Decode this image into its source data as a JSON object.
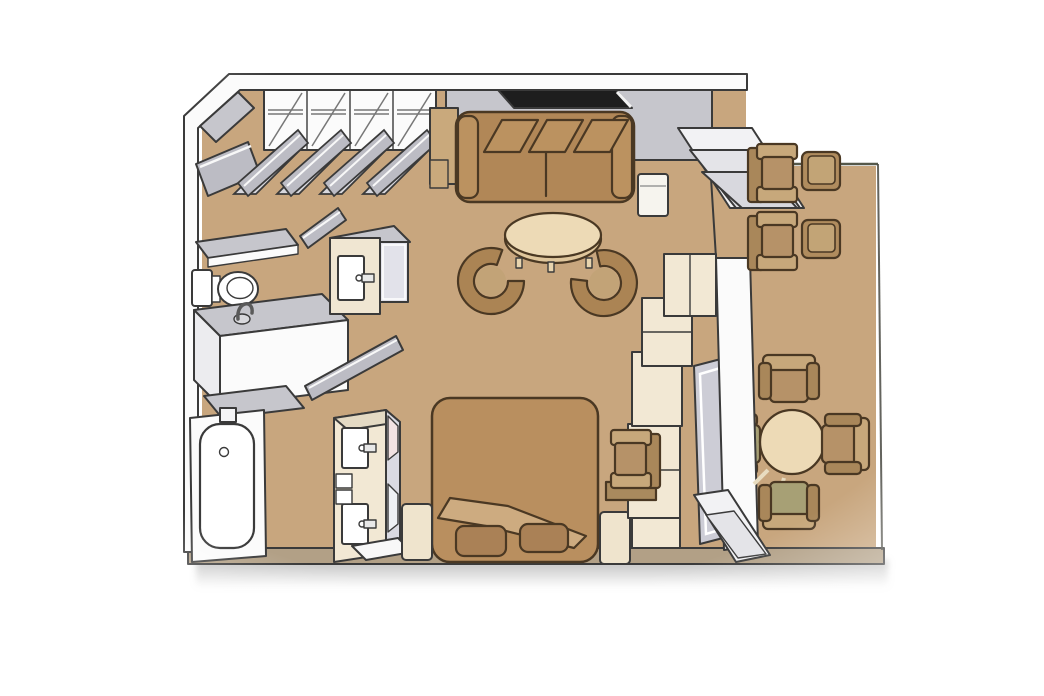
{
  "plan": {
    "kind": "floor-plan",
    "view": "isometric-top-down",
    "areas": [
      "entry",
      "closet-wall",
      "bathroom",
      "living-area",
      "bedroom-area",
      "balcony"
    ],
    "furniture": [
      "entry-door",
      "wardrobe-closet-bays",
      "closet-bifold-doors",
      "minibar-cabinet",
      "sofa",
      "wall-window",
      "sofa-side-table",
      "coffee-table",
      "tub-chair",
      "toilet",
      "sink-counter",
      "sink-faucet",
      "bathtub",
      "mirrored-cabinet",
      "wc-door",
      "bathroom-door",
      "vanity-dresser",
      "double-bed",
      "bed-fold",
      "pillow",
      "nightstand",
      "desk-chair",
      "desk-shelf",
      "wall-cabinet-unit",
      "sliding-glass-door",
      "threshold-steps",
      "door-sill",
      "balcony-lounge-chair",
      "balcony-side-table",
      "dining-table",
      "dining-chair"
    ],
    "counts": {
      "wardrobe_bays": 4,
      "tub_chairs": 2,
      "pillows": 2,
      "nightstands": 2,
      "lounge_chairs": 2,
      "balcony_side_tables": 2,
      "dining_chairs": 4
    }
  },
  "colors": {
    "background": "#ffffff",
    "outline": "#3a3a3a",
    "furniture_outline": "#4a3823",
    "floor": "#c8a67e",
    "wall_white": "#fbfbfb",
    "wall_face_gray": "#c6c6cc",
    "wall_bottom_tan": "#b2a086",
    "window_black": "#1e1e1e",
    "door_gray": "#bcbcc4",
    "door_gray_light": "#d7d7dd",
    "glass_gray": "#cdcdd6",
    "cream_cabinet": "#f2e8d4",
    "cream_furniture": "#efe4cd",
    "tan_cabinet": "#c9a97c",
    "sofa_brown": "#b18757",
    "sofa_cushion": "#bb9260",
    "bed_blanket": "#b98f5f",
    "bed_fold": "#cdab80",
    "pillow_brown": "#aa8156",
    "table_top_cream": "#eddab6",
    "table_lip": "#dfc69c",
    "tub_chair_brown": "#ab8454",
    "tub_chair_seat": "#c2a377",
    "balcony_chair_arm": "#c7a87b",
    "balcony_chair_back": "#a9875a",
    "balcony_chair_seat": "#b69268",
    "balcony_table": "#b08c5e",
    "balcony_table_top": "#c2a476",
    "olive_chair": "#a7a075",
    "mirror_gray": "#e2e2ea",
    "mirror_pink": "#f2e2e2",
    "white_fixture": "#ffffff",
    "shadow_gray": "#8a8a8a"
  }
}
